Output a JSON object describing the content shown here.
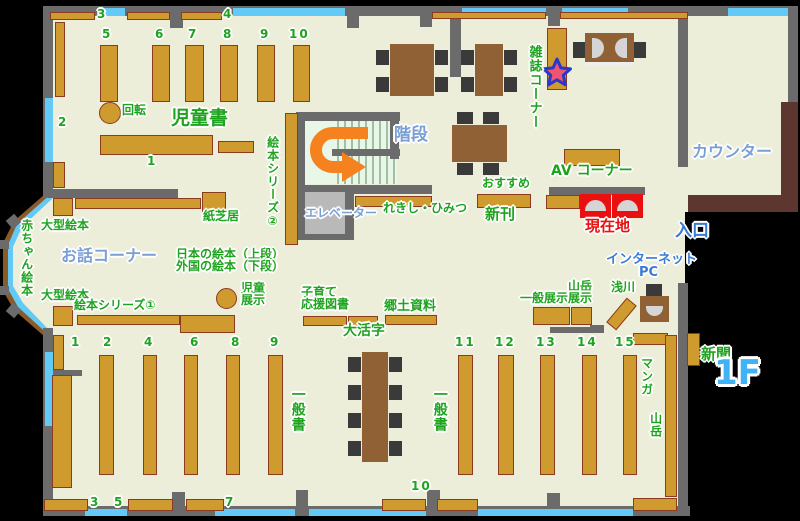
{
  "labels": {
    "jidosho": "児童書",
    "kaiten": "回転",
    "ehon_series2": "絵本シリーズ②",
    "kaidan": "階段",
    "elevator": "エレベーター",
    "rekishi_himitsu": "れきし・ひみつ",
    "zasshi_corner": "雑誌コーナー",
    "av_corner": "AV コーナー",
    "osusume": "おすすめ",
    "shinkan": "新刊",
    "genzaichi": "現在地",
    "counter": "カウンター",
    "iriguchi": "入口",
    "internet": "インターネット",
    "pc": "PC",
    "asakawa": "浅川",
    "ippan_tenji": "一般展示",
    "sangaku_tenji_1": "山岳",
    "sangaku_tenji_2": "展示",
    "kosodate_1": "子育て",
    "kosodate_2": "応援図書",
    "kyodo_shiryo": "郷土資料",
    "daikatsuji": "大活字",
    "ohanashi_corner": "お話コーナー",
    "akachan_ehon": "赤ちゃん絵本",
    "ogata_ehon": "大型絵本",
    "ehon_series1": "絵本シリーズ①",
    "nihon_no_ehon": "日本の絵本（上段）",
    "gaikoku_no_ehon": "外国の絵本（下段）",
    "jido_tenji_1": "児童",
    "jido_tenji_2": "展示",
    "kamishibai": "紙芝居",
    "ippansho": "一般書",
    "manga": "マンガ",
    "sangaku": "山岳",
    "shinbun": "新聞",
    "floor_badge": "1F"
  },
  "shelf_numbers": {
    "children_top": [
      "3",
      "4"
    ],
    "children_cols": [
      "5",
      "6",
      "7",
      "8",
      "9",
      "10"
    ],
    "children_row": [
      "1",
      "2"
    ],
    "general_cols": [
      "1",
      "2",
      "4",
      "6",
      "8",
      "9",
      "11",
      "12",
      "13",
      "14",
      "15"
    ],
    "general_bottom": [
      "3",
      "5",
      "7",
      "10"
    ]
  },
  "colors": {
    "floor": "#edeeda",
    "outside": "#000000",
    "wall": "#6b6b6b",
    "window": "#63c9f7",
    "shelf": "#cf9a2e",
    "shelf_border": "#8a3b20",
    "table": "#8f6134",
    "chair": "#3a3a3a",
    "counter": "#5d3630",
    "elevator": "#b9b9b9",
    "stairs_bg": "#e9f7e9",
    "label_green": "#1ea31e",
    "label_blue": "#7a9fd4",
    "label_blue_bright": "#3a7bd5",
    "label_red": "#e81010",
    "arrow_orange": "#f5821e",
    "star_fill": "#ef5570",
    "star_stroke": "#2838cc",
    "floor_badge_blue": "#3fb3f5"
  }
}
